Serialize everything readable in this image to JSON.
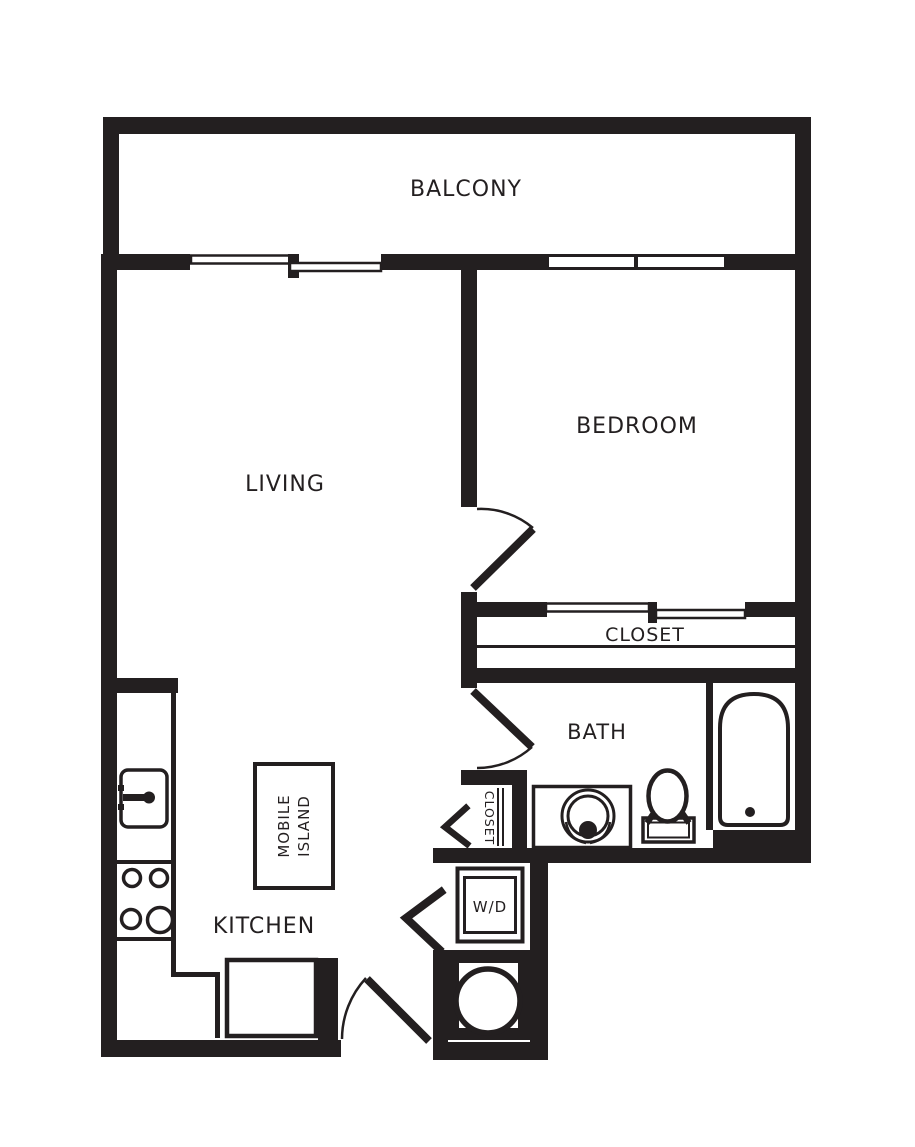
{
  "meta": {
    "type": "apartment-floor-plan",
    "colors": {
      "wall": "#231f20",
      "background": "#ffffff"
    }
  },
  "rooms": {
    "balcony": {
      "label": "BALCONY"
    },
    "living": {
      "label": "LIVING"
    },
    "bedroom": {
      "label": "BEDROOM"
    },
    "closet": {
      "label": "CLOSET"
    },
    "bath": {
      "label": "BATH"
    },
    "kitchen": {
      "label": "KITCHEN"
    }
  },
  "fixtures": {
    "washer_dryer": {
      "label": "W/D"
    },
    "bath_closet": {
      "label": "CLOSET"
    },
    "mobile_island": {
      "line1": "MOBILE",
      "line2": "ISLAND"
    }
  }
}
